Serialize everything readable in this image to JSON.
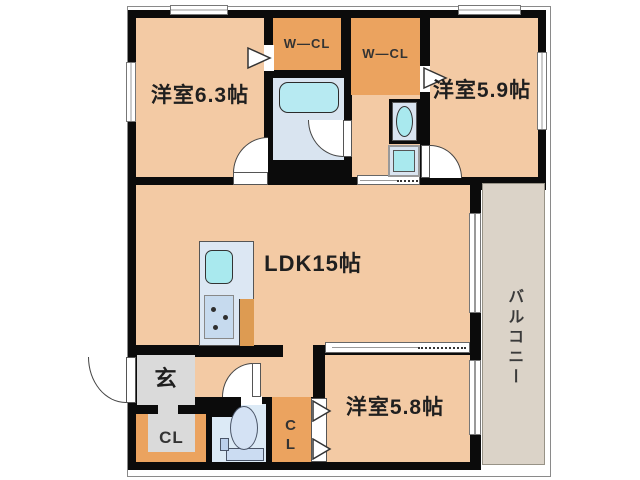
{
  "rooms": {
    "bedroom_63": "洋室6.3帖",
    "wcl_left": "W—CL",
    "wcl_right": "W—CL",
    "bedroom_59": "洋室5.9帖",
    "ldk": "LDK15帖",
    "balcony": "バルコニー",
    "entrance": "玄",
    "entrance_closet": "CL",
    "bedroom58_closet": "CL",
    "bedroom_58": "洋室5.8帖"
  },
  "palette": {
    "wall": "#0b0b0b",
    "room_peach": "#F3CAA4",
    "closet_orange": "#EBA35F",
    "bath_blue": "#D9E4F0",
    "toilet_blue": "#DCEAF6",
    "entry_gray": "#DADADA",
    "balcony_gray": "#DBD3C8",
    "fixture_cyan": "#A9E9EE",
    "tub_cyan": "#B7EAF2",
    "counter_blue": "#DCE7F3"
  }
}
